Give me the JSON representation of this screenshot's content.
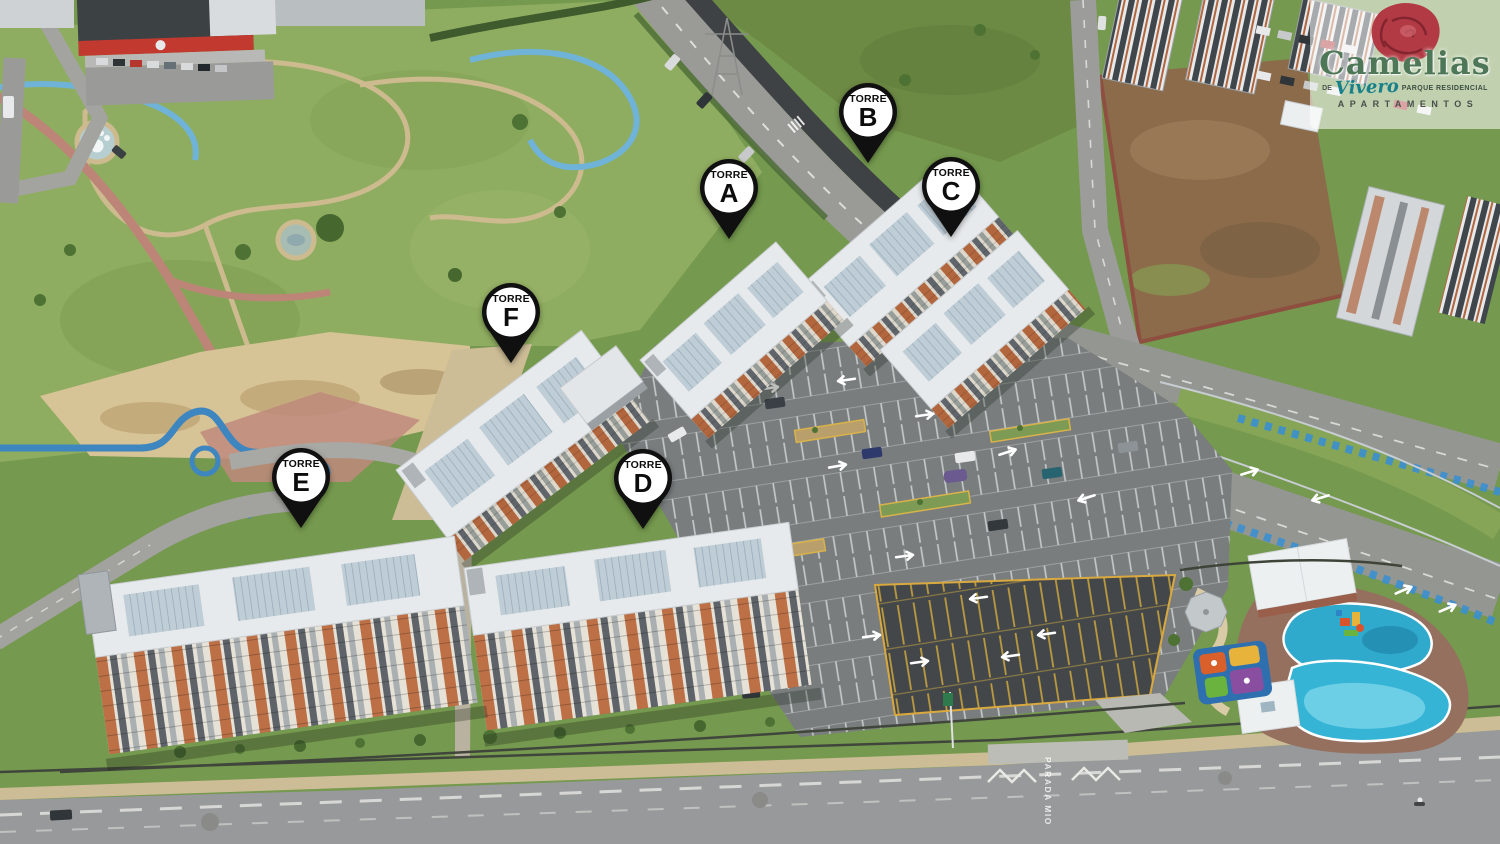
{
  "logo": {
    "brand": "Camelias",
    "de": "DE",
    "script": "Vivero",
    "tagline": "PARQUE RESIDENCIAL",
    "subtitle": "APARTAMENTOS"
  },
  "pins": [
    {
      "word": "TORRE",
      "letter": "A"
    },
    {
      "word": "TORRE",
      "letter": "B"
    },
    {
      "word": "TORRE",
      "letter": "C"
    },
    {
      "word": "TORRE",
      "letter": "D"
    },
    {
      "word": "TORRE",
      "letter": "E"
    },
    {
      "word": "TORRE",
      "letter": "F"
    }
  ],
  "road_marking": {
    "text": "PARADA MIO"
  },
  "colors": {
    "pin_black": "#101010",
    "pin_white": "#ffffff",
    "brand_green": "#4e7758",
    "flower_red": "#b23a44",
    "script_teal": "#17808a",
    "pool_blue": "#35b4d6",
    "grass_green": "#75994e",
    "road_gray": "#98999a",
    "facade_brick": "#b2663e"
  }
}
